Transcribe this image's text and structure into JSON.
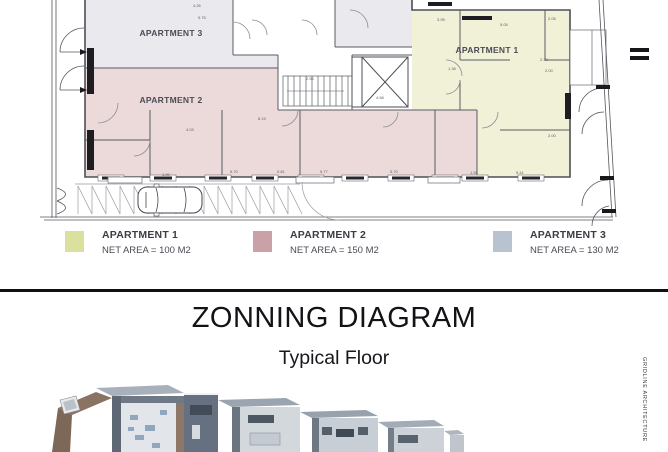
{
  "plan": {
    "labels": {
      "apartment1": "APARTMENT 1",
      "apartment2": "APARTMENT 2",
      "apartment3": "APARTMENT 3"
    },
    "zone_colors": {
      "apartment1": "#f1f1d8",
      "apartment2": "#ecdada",
      "apartment3": "#e9e9ee"
    },
    "dimensions": [
      {
        "t": "4.26",
        "x": 193,
        "y": 3
      },
      {
        "t": "5.75",
        "x": 198,
        "y": 15
      },
      {
        "t": "3.95",
        "x": 437,
        "y": 17
      },
      {
        "t": "5.05",
        "x": 500,
        "y": 22
      },
      {
        "t": "2.05",
        "x": 548,
        "y": 16
      },
      {
        "t": "2.13",
        "x": 540,
        "y": 57
      },
      {
        "t": "2.00",
        "x": 545,
        "y": 68
      },
      {
        "t": "1.38",
        "x": 448,
        "y": 66
      },
      {
        "t": "2.54",
        "x": 306,
        "y": 76
      },
      {
        "t": "4.58",
        "x": 376,
        "y": 95
      },
      {
        "t": "8.15",
        "x": 258,
        "y": 116
      },
      {
        "t": "4.03",
        "x": 186,
        "y": 127
      },
      {
        "t": "1.90",
        "x": 162,
        "y": 172
      },
      {
        "t": "5.70",
        "x": 230,
        "y": 169
      },
      {
        "t": "0.81",
        "x": 277,
        "y": 169
      },
      {
        "t": "5.77",
        "x": 320,
        "y": 169
      },
      {
        "t": "5.70",
        "x": 390,
        "y": 169
      },
      {
        "t": "1.55",
        "x": 470,
        "y": 170
      },
      {
        "t": "5.41",
        "x": 516,
        "y": 170
      },
      {
        "t": "2.00",
        "x": 548,
        "y": 133
      }
    ]
  },
  "legend": {
    "items": [
      {
        "label": "APARTMENT 1",
        "net_area": "NET AREA = 100 M2",
        "color": "#dce09e"
      },
      {
        "label": "APARTMENT 2",
        "net_area": "NET AREA = 150 M2",
        "color": "#c9a1a6"
      },
      {
        "label": "APARTMENT 3",
        "net_area": "NET AREA = 130 M2",
        "color": "#b9c2cf"
      }
    ]
  },
  "section": {
    "title": "ZONNING DIAGRAM",
    "subtitle": "Typical Floor"
  },
  "credit": {
    "text": "GRIDLINE ARCHITECTURE"
  }
}
